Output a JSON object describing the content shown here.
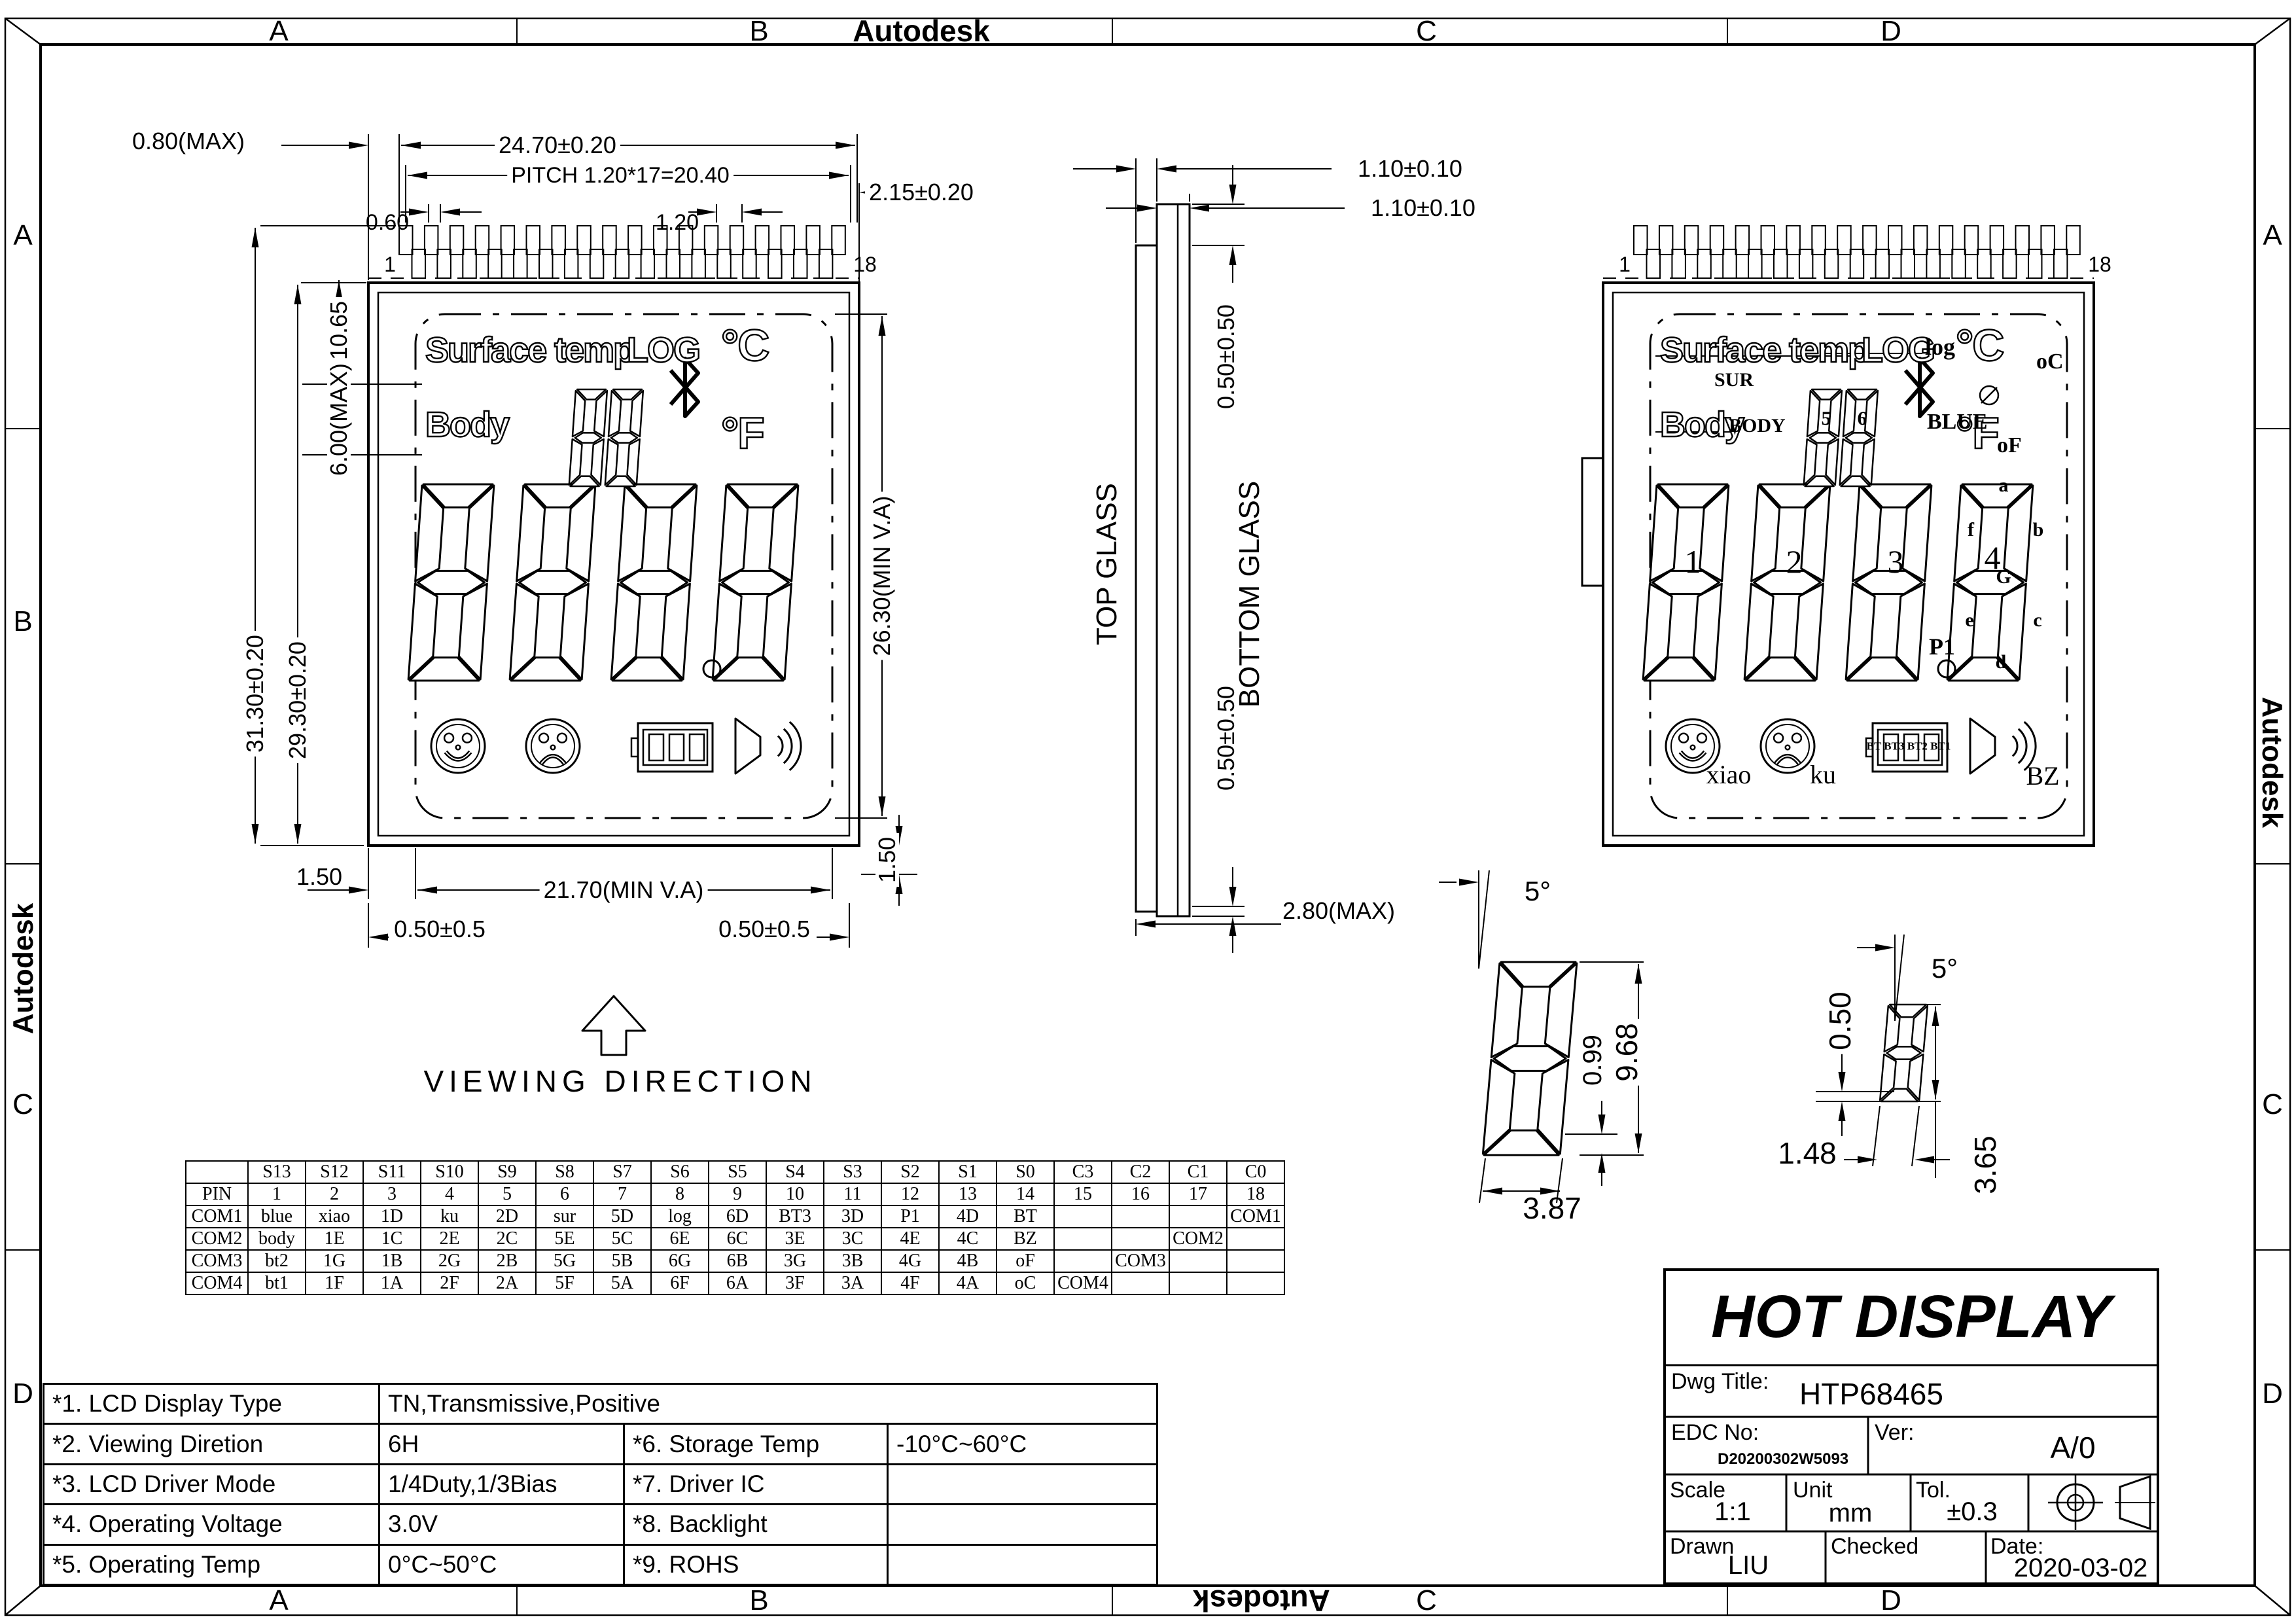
{
  "sheet": {
    "watermark": "Autodesk",
    "zones_top": [
      "A",
      "B",
      "C",
      "D"
    ],
    "zones_bottom": [
      "A",
      "B",
      "C",
      "D"
    ],
    "zones_left": [
      "A",
      "B",
      "C",
      "D"
    ],
    "zones_right": [
      "A",
      "C",
      "D"
    ]
  },
  "left_view": {
    "pin_first": "1",
    "pin_last": "18",
    "surface": "Surface temp",
    "log": "LOG",
    "deg_c": "°C",
    "body": "Body",
    "deg_f": "°F"
  },
  "right_view": {
    "pin_first": "1",
    "pin_last": "18",
    "surface": "Surface temp",
    "log": "LOG",
    "deg_c": "°C",
    "body": "Body",
    "deg_f": "°F",
    "sur": "SUR",
    "log_label": "log",
    "blue": "BLUE",
    "oc": "oC",
    "body_label": "BODY",
    "d5": "5",
    "d6": "6",
    "of": "oF",
    "d1": "1",
    "d2": "2",
    "d3": "3",
    "d4": "4",
    "seg_a": "a",
    "seg_b": "b",
    "seg_c": "c",
    "seg_d": "d",
    "seg_e": "e",
    "seg_f": "f",
    "seg_g": "G",
    "p1": "P1",
    "xiao": "xiao",
    "ku": "ku",
    "bt": "BT BT3 BT2 BT1",
    "bz": "BZ"
  },
  "dims": {
    "d080": "0.80(MAX)",
    "d2470": "24.70±0.20",
    "pitch": "PITCH 1.20*17=20.40",
    "d060": "0.60",
    "d120": "1.20",
    "d215": "2.15±0.20",
    "d3130": "31.30±0.20",
    "d2930": "29.30±0.20",
    "d1065": "10.65",
    "d600": "6.00(MAX)",
    "d2630": "26.30(MIN V.A)",
    "d150l": "1.50",
    "d2170": "21.70(MIN V.A)",
    "d150r": "1.50",
    "d050l": "0.50±0.5",
    "d050r": "0.50±0.5"
  },
  "side_view": {
    "top_glass": "TOP GLASS",
    "bottom_glass": "BOTTOM GLASS",
    "d110a": "1.10±0.10",
    "d110b": "1.10±0.10",
    "d050t": "0.50±0.50",
    "d050b": "0.50±0.50",
    "d280": "2.80(MAX)"
  },
  "viewing_direction": "VIEWING DIRECTION",
  "details": {
    "angle1": "5°",
    "h1": "9.68",
    "seg1": "0.99",
    "w1": "3.87",
    "angle2": "5°",
    "a2": "0.50",
    "b2": "1.48",
    "c2": "3.65"
  },
  "pin_table": {
    "rows": [
      [
        "",
        "S13",
        "S12",
        "S11",
        "S10",
        "S9",
        "S8",
        "S7",
        "S6",
        "S5",
        "S4",
        "S3",
        "S2",
        "S1",
        "S0",
        "C3",
        "C2",
        "C1",
        "C0"
      ],
      [
        "PIN",
        "1",
        "2",
        "3",
        "4",
        "5",
        "6",
        "7",
        "8",
        "9",
        "10",
        "11",
        "12",
        "13",
        "14",
        "15",
        "16",
        "17",
        "18"
      ],
      [
        "COM1",
        "blue",
        "xiao",
        "1D",
        "ku",
        "2D",
        "sur",
        "5D",
        "log",
        "6D",
        "BT3",
        "3D",
        "P1",
        "4D",
        "BT",
        "",
        "",
        "",
        "COM1"
      ],
      [
        "COM2",
        "body",
        "1E",
        "1C",
        "2E",
        "2C",
        "5E",
        "5C",
        "6E",
        "6C",
        "3E",
        "3C",
        "4E",
        "4C",
        "BZ",
        "",
        "",
        "COM2",
        ""
      ],
      [
        "COM3",
        "bt2",
        "1G",
        "1B",
        "2G",
        "2B",
        "5G",
        "5B",
        "6G",
        "6B",
        "3G",
        "3B",
        "4G",
        "4B",
        "oF",
        "",
        "COM3",
        "",
        ""
      ],
      [
        "COM4",
        "bt1",
        "1F",
        "1A",
        "2F",
        "2A",
        "5F",
        "5A",
        "6F",
        "6A",
        "3F",
        "3A",
        "4F",
        "4A",
        "oC",
        "COM4",
        "",
        "",
        ""
      ]
    ]
  },
  "spec_table": {
    "rows": [
      {
        "label": "*1. LCD Display Type",
        "value": "TN,Transmissive,Positive",
        "span": true,
        "label2": "",
        "value2": ""
      },
      {
        "label": "*2. Viewing Diretion",
        "value": "6H",
        "label2": "*6. Storage Temp",
        "value2": "-10°C~60°C"
      },
      {
        "label": "*3. LCD Driver Mode",
        "value": "1/4Duty,1/3Bias",
        "label2": "*7. Driver IC",
        "value2": ""
      },
      {
        "label": "*4. Operating Voltage",
        "value": "3.0V",
        "label2": "*8. Backlight",
        "value2": ""
      },
      {
        "label": "*5. Operating Temp",
        "value": "0°C~50°C",
        "label2": "*9. ROHS",
        "value2": ""
      }
    ]
  },
  "title_block": {
    "company": "HOT DISPLAY",
    "dwg_title_label": "Dwg Title:",
    "dwg_title": "HTP68465",
    "edc_label": "EDC No:",
    "edc_no": "D20200302W5093",
    "ver_label": "Ver:",
    "ver": "A/0",
    "scale_label": "Scale",
    "scale": "1:1",
    "unit_label": "Unit",
    "unit": "mm",
    "tol_label": "Tol.",
    "tol": "±0.3",
    "drawn_label": "Drawn",
    "drawn": "LIU",
    "checked_label": "Checked",
    "date_label": "Date:",
    "date": "2020-03-02"
  }
}
